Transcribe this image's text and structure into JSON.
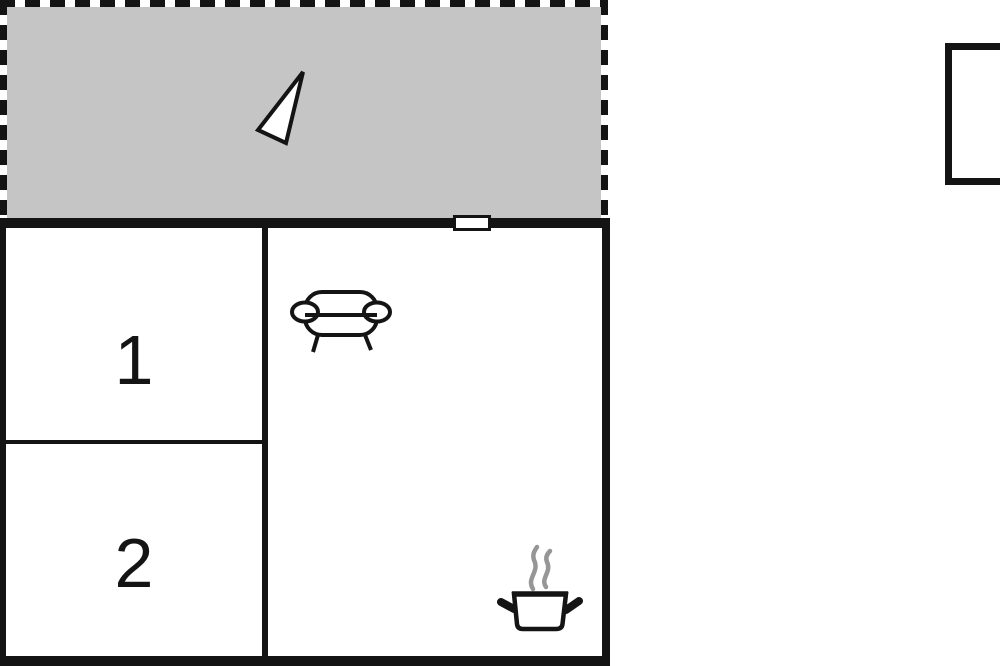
{
  "floorplan": {
    "rooms": [
      {
        "id": "room-1",
        "label": "1"
      },
      {
        "id": "room-2",
        "label": "2"
      }
    ],
    "icons": [
      "north-arrow-icon",
      "sofa-icon",
      "cooking-pot-icon"
    ]
  },
  "colors": {
    "wall": "#141414",
    "terrace_fill": "#c5c5c5",
    "steam": "#969696",
    "paper": "#ffffff"
  }
}
